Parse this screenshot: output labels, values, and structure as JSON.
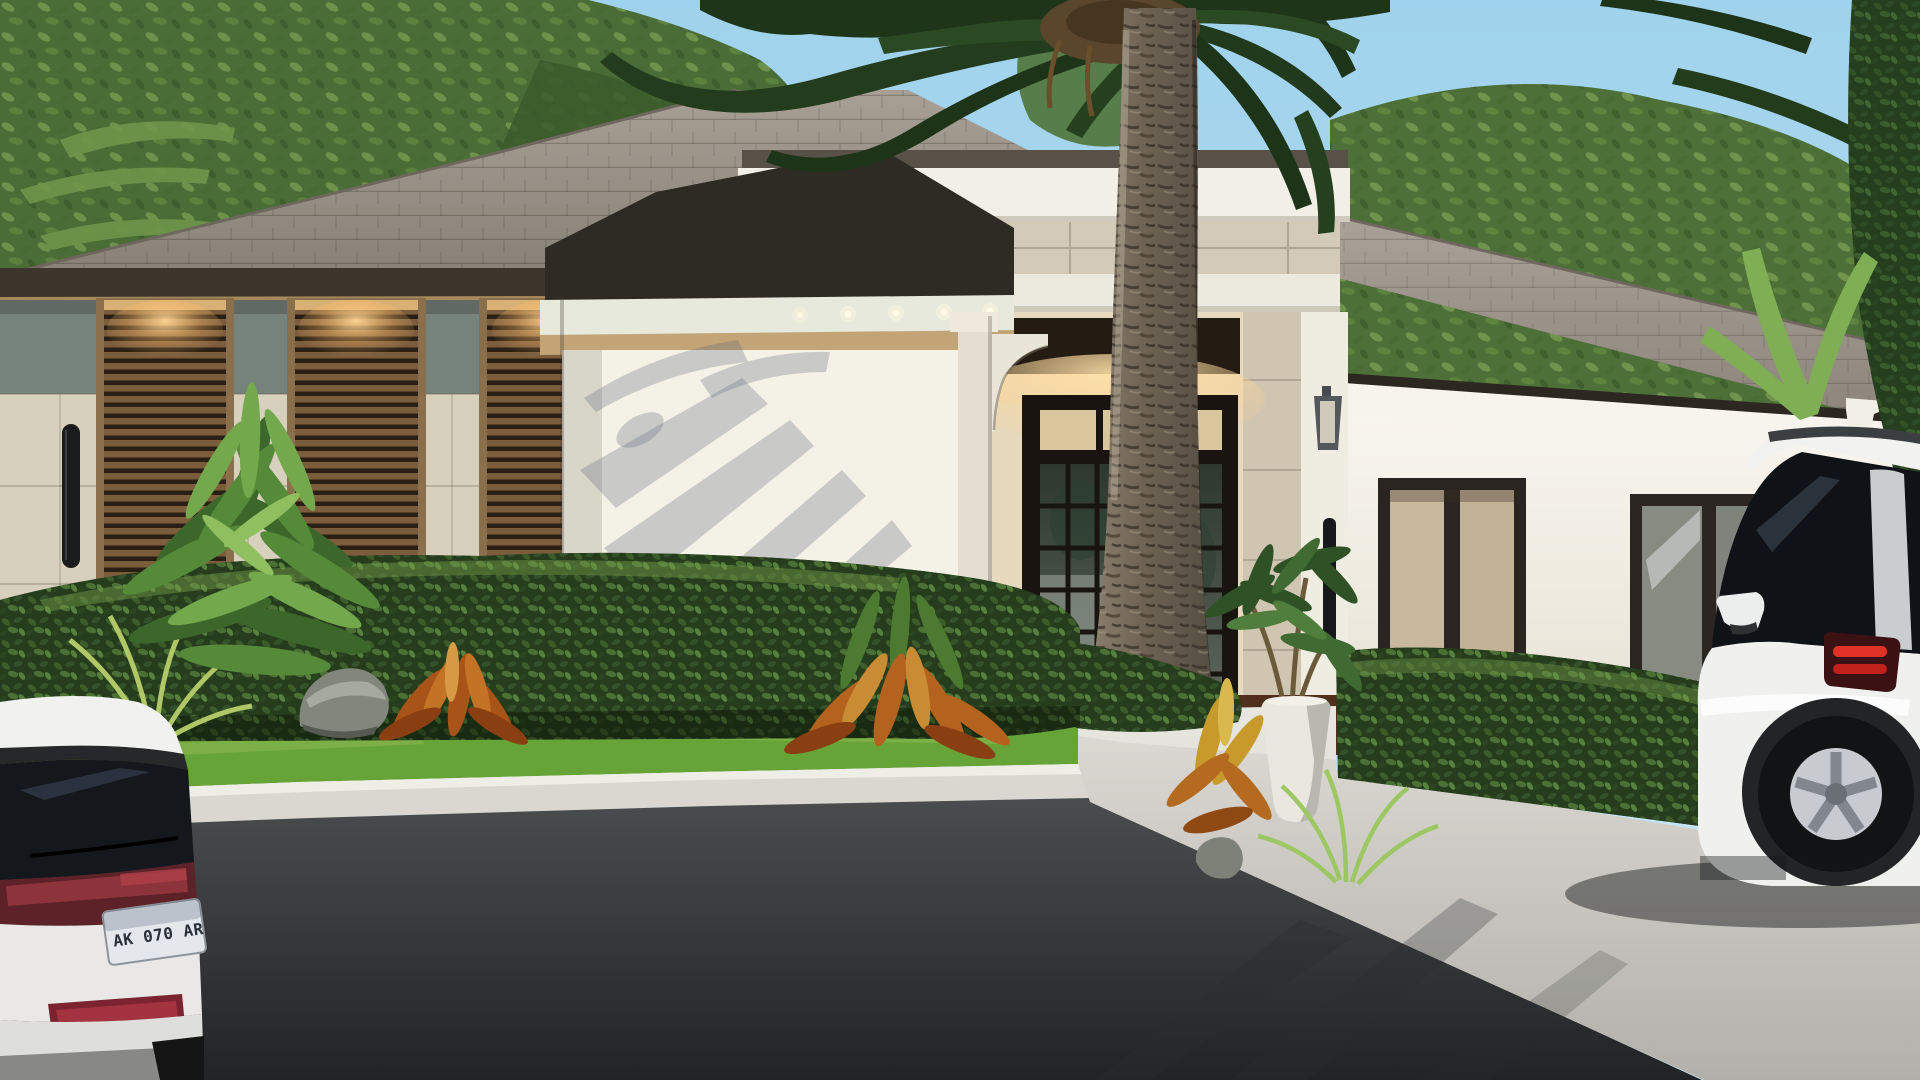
{
  "meta": {
    "title": "Front exterior 3D rendering — single-story coastal modern home",
    "view": "street-facing elevation, daytime, clear sky"
  },
  "scene": {
    "license_plate": "AK 070 AR",
    "sky": "clear light blue",
    "house": {
      "style": "coastal contemporary, hip shingle roof, cream stucco and travertine stone",
      "left_wing": {
        "louvered_windows": 3,
        "wall_sconces": 2,
        "downlights_lit": true
      },
      "entry_tower": {
        "stone_band": true,
        "white_cornice_bands": 2,
        "entry_door": "bronze-framed french door with divided lites and transom",
        "lantern_sconce": 1,
        "corbels": 2
      },
      "right_wing": {
        "windows": 2,
        "window_1": "beige interior shades",
        "window_2": "reflective glass",
        "corbel": 1
      }
    },
    "landscape": {
      "palm_tree": "tall center palm in front of entry",
      "hedges": 2,
      "lawn": "bright green strip",
      "planter": "white urn with schefflera",
      "accent_plants": [
        "crotons (orange)",
        "green shrub",
        "ferns",
        "ornamental grasses",
        "rocks"
      ]
    },
    "vehicles": {
      "left": "white hatchback, rear view, dark tinted rear window, red tail-light band",
      "right": "white SUV parked on concrete driveway, roof rails, red tail lights"
    },
    "ground": [
      "mulch bed",
      "lawn",
      "white curb",
      "dark asphalt road",
      "light concrete driveway with palm shadows"
    ]
  },
  "palette": {
    "sky_top": "#9fd2ec",
    "sky_bottom": "#cfeaf6",
    "roof_shingle": "#9a9287",
    "roof_shadowed": "#2e2a24",
    "fascia_dark_bronze": "#3b352b",
    "stucco_white": "#f4f1e6",
    "stone_beige": "#d7d0bd",
    "stone_band_gray_green": "#76827c",
    "travertine": "#d3cab7",
    "louver_brown": "#7b5c3b",
    "door_bronze": "#191410",
    "warm_glow": "#e9d6ae",
    "hedge_green": "#26411d",
    "lawn_green": "#67a437",
    "asphalt": "#3b3d3f",
    "driveway_concrete": "#cfcdc6",
    "croton_orange": "#b4631f",
    "tail_light_red": "#8c333c",
    "suv_tail_red": "#e03126"
  }
}
